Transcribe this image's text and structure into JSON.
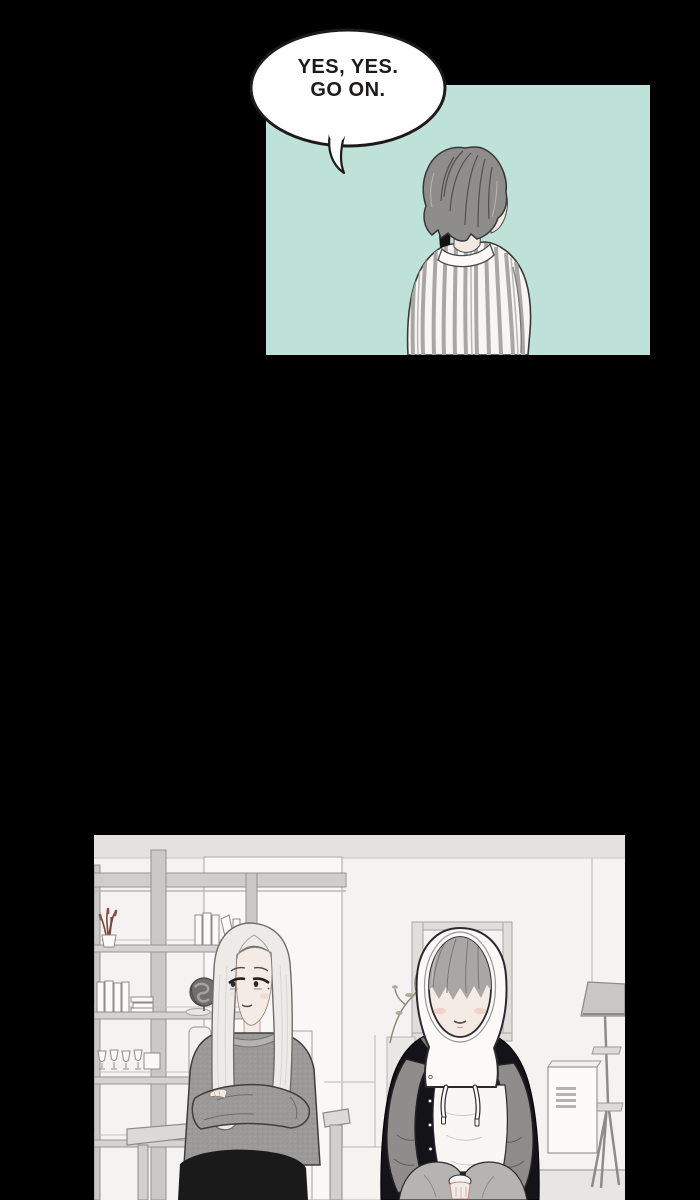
{
  "speech_bubble": {
    "line1": "YES, YES.",
    "line2": "GO ON."
  },
  "colors": {
    "page_bg": "#000000",
    "panel_mint": "#bee1d8",
    "bubble_fill": "#ffffff",
    "ink": "#1d1b1a",
    "wall": "#f4f3f1",
    "wall_strip": "#e3e2e0",
    "shelf": "#cfcdcb",
    "hair_man": "#8f8d8b",
    "hair_woman": "#edebe7",
    "hair_boy": "#a9a7a5",
    "sweater": "#9c9a98",
    "jacket": "#141418",
    "sleeve": "#8f8d8b",
    "skin": "#f5ebe5",
    "blush": "#efcac4",
    "skirt": "#1a1a1a",
    "pants": "#b6b4b2"
  }
}
